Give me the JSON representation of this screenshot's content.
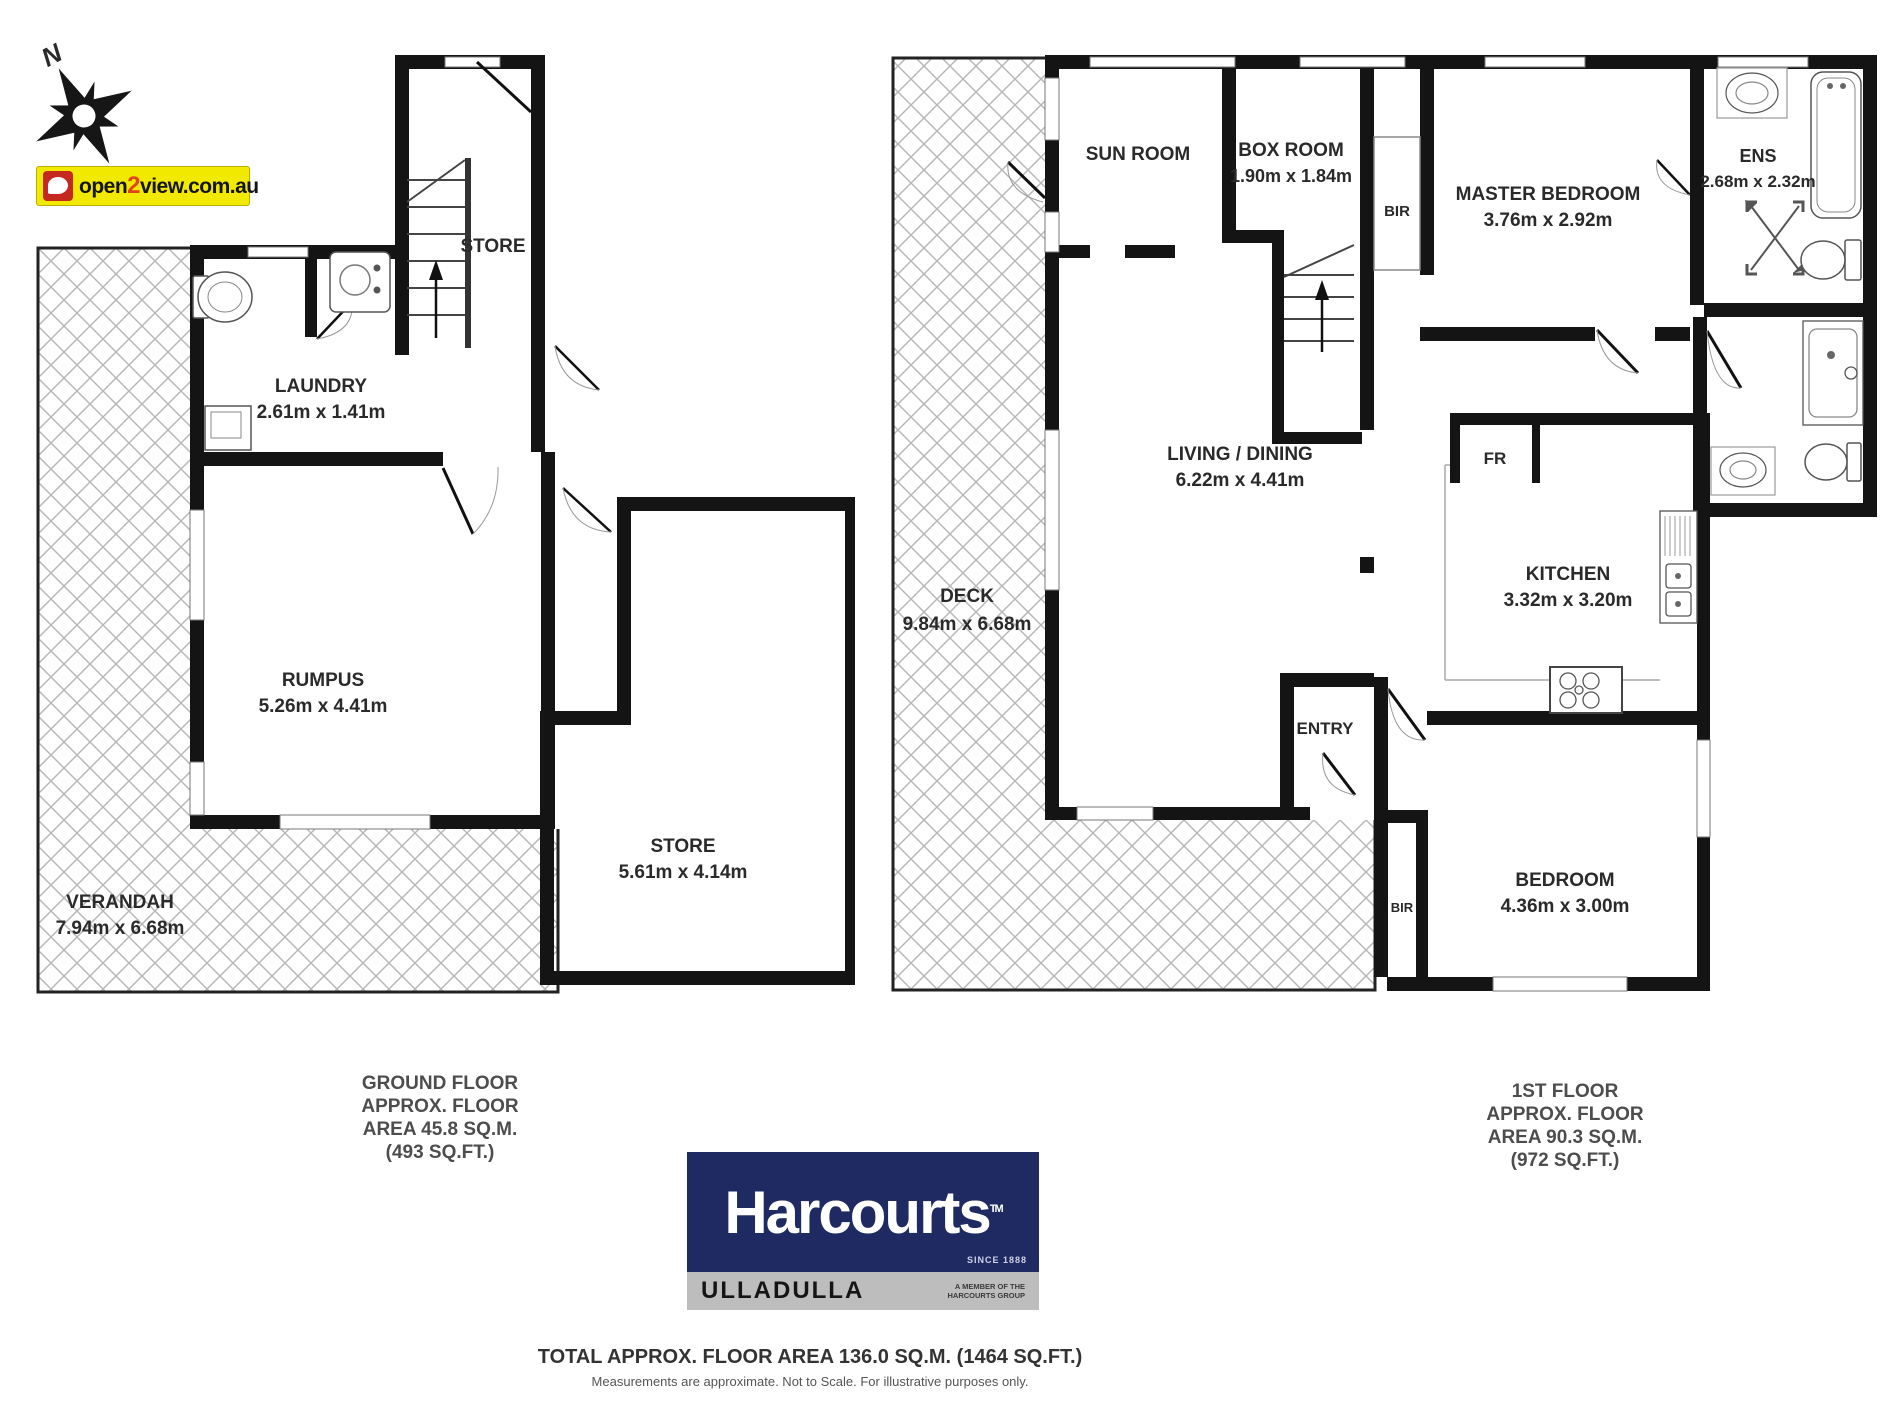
{
  "compass": {
    "label": "N"
  },
  "watermark": {
    "open": "open",
    "two": "2",
    "view": "view.com.au"
  },
  "ground_floor": {
    "rooms": {
      "verandah": {
        "name": "VERANDAH",
        "dims": "7.94m x 6.68m"
      },
      "laundry": {
        "name": "LAUNDRY",
        "dims": "2.61m x 1.41m"
      },
      "store_upper": {
        "name": "STORE"
      },
      "rumpus": {
        "name": "RUMPUS",
        "dims": "5.26m x 4.41m"
      },
      "store": {
        "name": "STORE",
        "dims": "5.61m x 4.14m"
      }
    },
    "caption": {
      "line1": "GROUND FLOOR",
      "line2": "APPROX. FLOOR",
      "line3": "AREA 45.8 SQ.M.",
      "line4": "(493 SQ.FT.)"
    }
  },
  "first_floor": {
    "rooms": {
      "deck": {
        "name": "DECK",
        "dims": "9.84m x 6.68m"
      },
      "sun_room": {
        "name": "SUN ROOM"
      },
      "box_room": {
        "name": "BOX ROOM",
        "dims": "1.90m x 1.84m"
      },
      "bir_top": {
        "name": "BIR"
      },
      "master_bedroom": {
        "name": "MASTER BEDROOM",
        "dims": "3.76m x 2.92m"
      },
      "ens": {
        "name": "ENS",
        "dims": "2.68m x 2.32m"
      },
      "living_dining": {
        "name": "LIVING / DINING",
        "dims": "6.22m x 4.41m"
      },
      "fr": {
        "name": "FR"
      },
      "kitchen": {
        "name": "KITCHEN",
        "dims": "3.32m x 3.20m"
      },
      "entry": {
        "name": "ENTRY"
      },
      "bir_bottom": {
        "name": "BIR"
      },
      "bedroom": {
        "name": "BEDROOM",
        "dims": "4.36m x 3.00m"
      }
    },
    "caption": {
      "line1": "1ST FLOOR",
      "line2": "APPROX. FLOOR",
      "line3": "AREA 90.3 SQ.M.",
      "line4": "(972 SQ.FT.)"
    }
  },
  "branding": {
    "agency": {
      "name": "Harcourts",
      "tm": "TM",
      "since": "SINCE 1888",
      "office": "ULLADULLA",
      "member_line1": "A MEMBER OF THE",
      "member_line2": "HARCOURTS GROUP"
    },
    "colors": {
      "harcourts_navy": "#1f2a63",
      "harcourts_gray": "#bdbdbd",
      "open2view_yellow": "#f2e900",
      "open2view_red": "#c4281f",
      "wall_black": "#141414",
      "hatch_gray": "#b8b8b8"
    }
  },
  "footer": {
    "total": "TOTAL APPROX. FLOOR AREA 136.0 SQ.M. (1464 SQ.FT.)",
    "disclaimer": "Measurements are approximate. Not to Scale. For illustrative purposes only."
  }
}
